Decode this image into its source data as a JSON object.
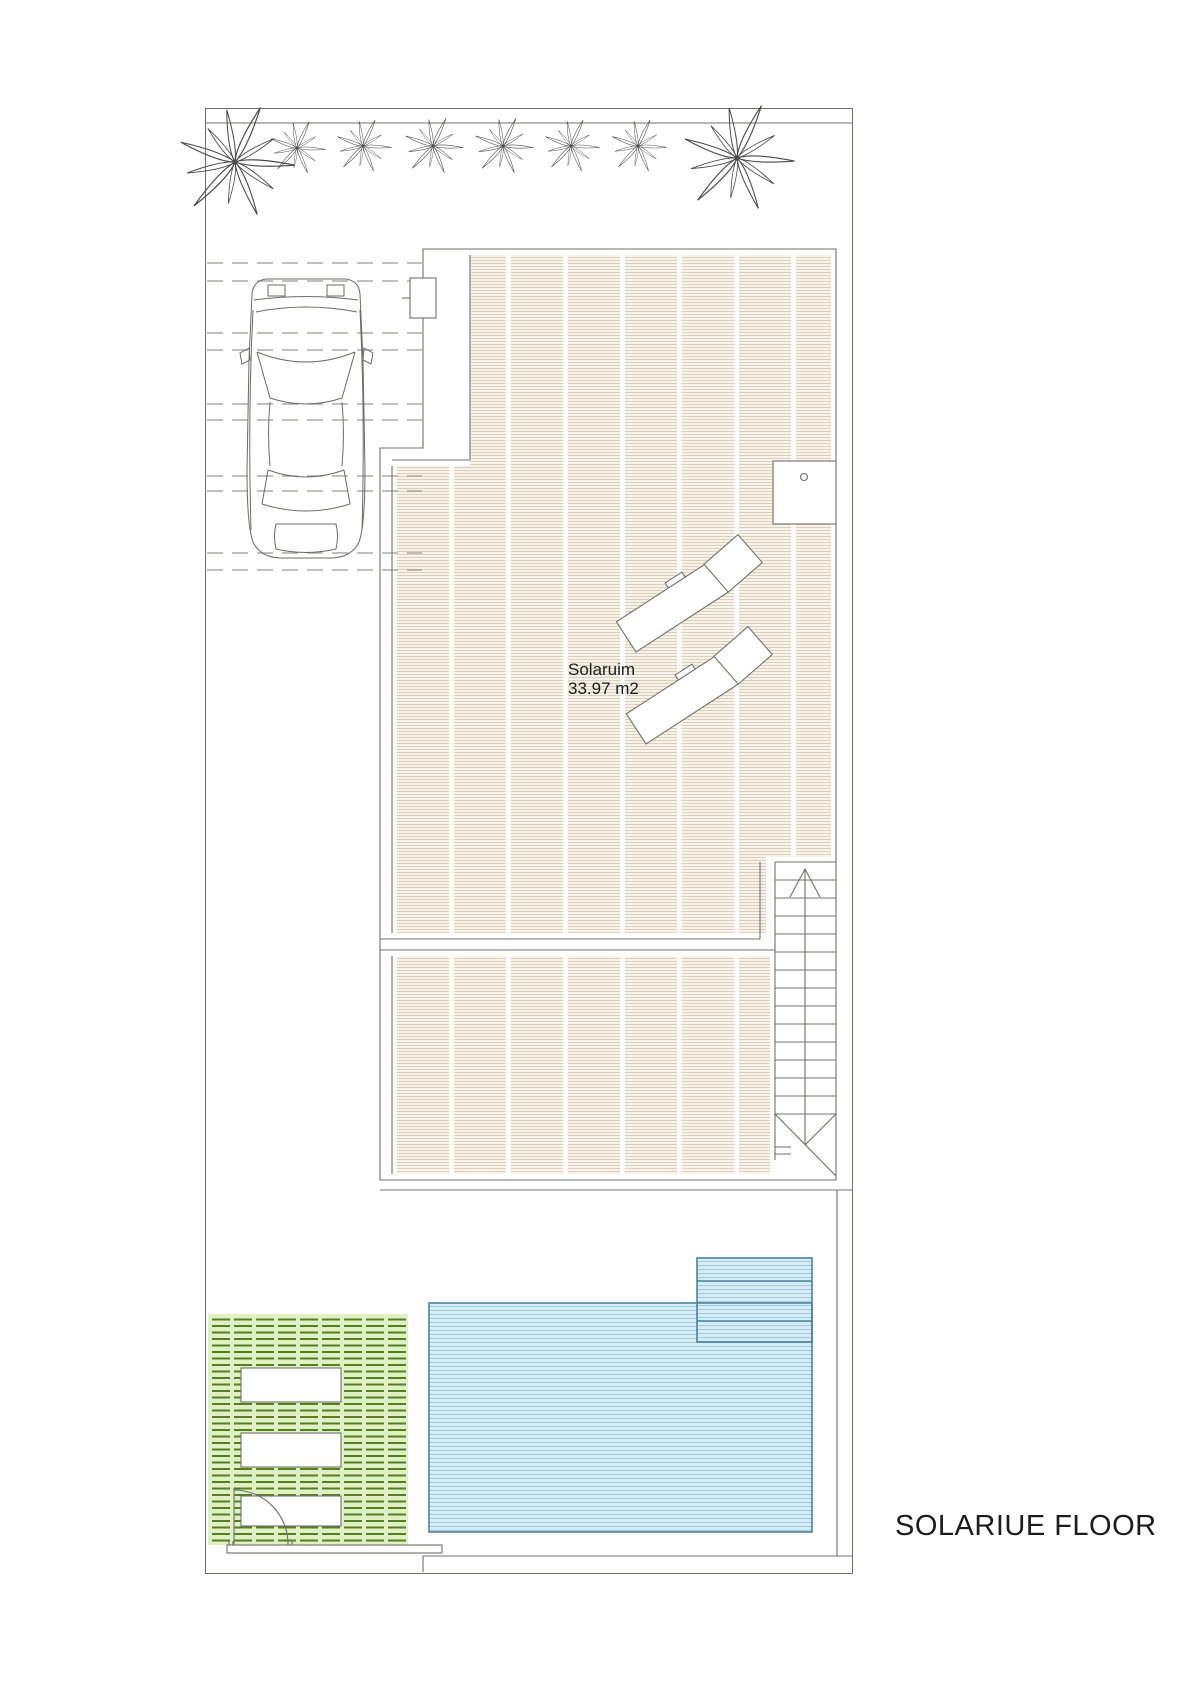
{
  "labels": {
    "room_name": "Solaruim",
    "room_area": "33.97 m2",
    "title": "SOLARIUE FLOOR"
  },
  "colors": {
    "line": "#70706a",
    "line-light": "#9a9a94",
    "deck-fill": "#f7f2ea",
    "deck-stripe": "#ddd0ba",
    "pool-fill": "#d6ecf4",
    "pool-stripe": "#9fcbdc",
    "pool-border": "#4d8399",
    "grass-fill": "#dff0c4",
    "grass-stripe": "#55801e",
    "text": "#1c1c1c",
    "page": "#ffffff"
  },
  "symbols": {
    "plants": "palm-tree-top-view",
    "plant_count": 8,
    "vehicle": "car-top-view",
    "loungers": "sun-lounger",
    "lounger_count": 2,
    "stairs": "staircase-up-arrow",
    "pool": "swimming-pool-with-steps",
    "lawn": "grass-with-paving-slabs",
    "gate": "door-swing-arc",
    "shower": "outdoor-shower-box"
  }
}
